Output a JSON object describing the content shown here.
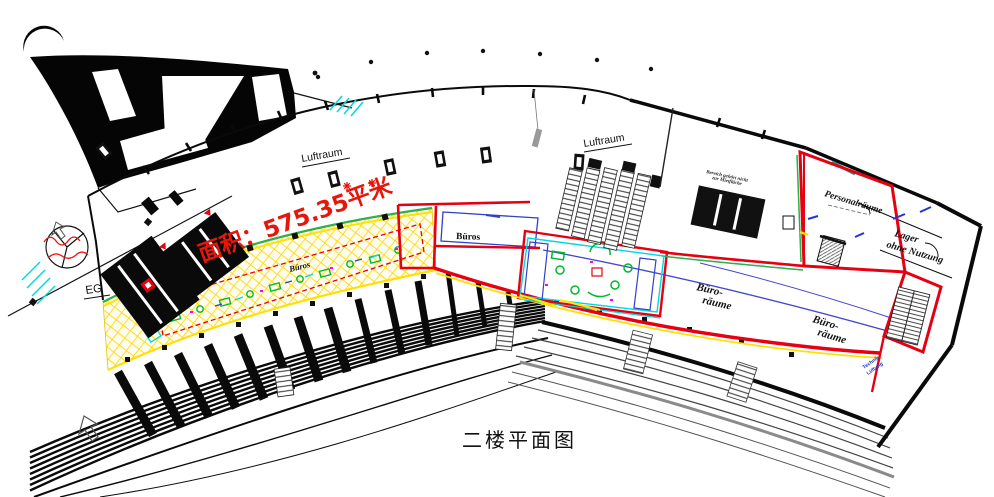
{
  "plan": {
    "title": "二楼平面图",
    "area_label": "面积：575.35平米",
    "labels": {
      "luftraum_left": "Luftraum",
      "luftraum_center": "Luftraum",
      "eg": "EG",
      "bueros_band": "Büros",
      "bueros_room": "Büros",
      "buero_raeume_a_line1": "Büro-",
      "buero_raeume_a_line2": "räume",
      "buero_raeume_b_line1": "Büro-",
      "buero_raeume_b_line2": "räume",
      "personalraeume": "Personalräume",
      "lager_line1": "Lager",
      "lager_line2": "ohne Nutzung",
      "note_line1": "Bereich gehört nicht",
      "note_line2": "zur Mietfläche",
      "technik_line1": "Technik",
      "technik_line2": "Lüftung"
    },
    "colors": {
      "highlight_red": "#e8150b",
      "boundary_red": "#e60012",
      "hatch_yellow": "#ffd800",
      "band_yellow": "#ffe000",
      "accent_green": "#2fae4a",
      "furniture_green": "#00b830",
      "accent_cyan": "#00d8e0",
      "accent_blue": "#3340c8",
      "accent_magenta": "#ff00ff"
    }
  }
}
